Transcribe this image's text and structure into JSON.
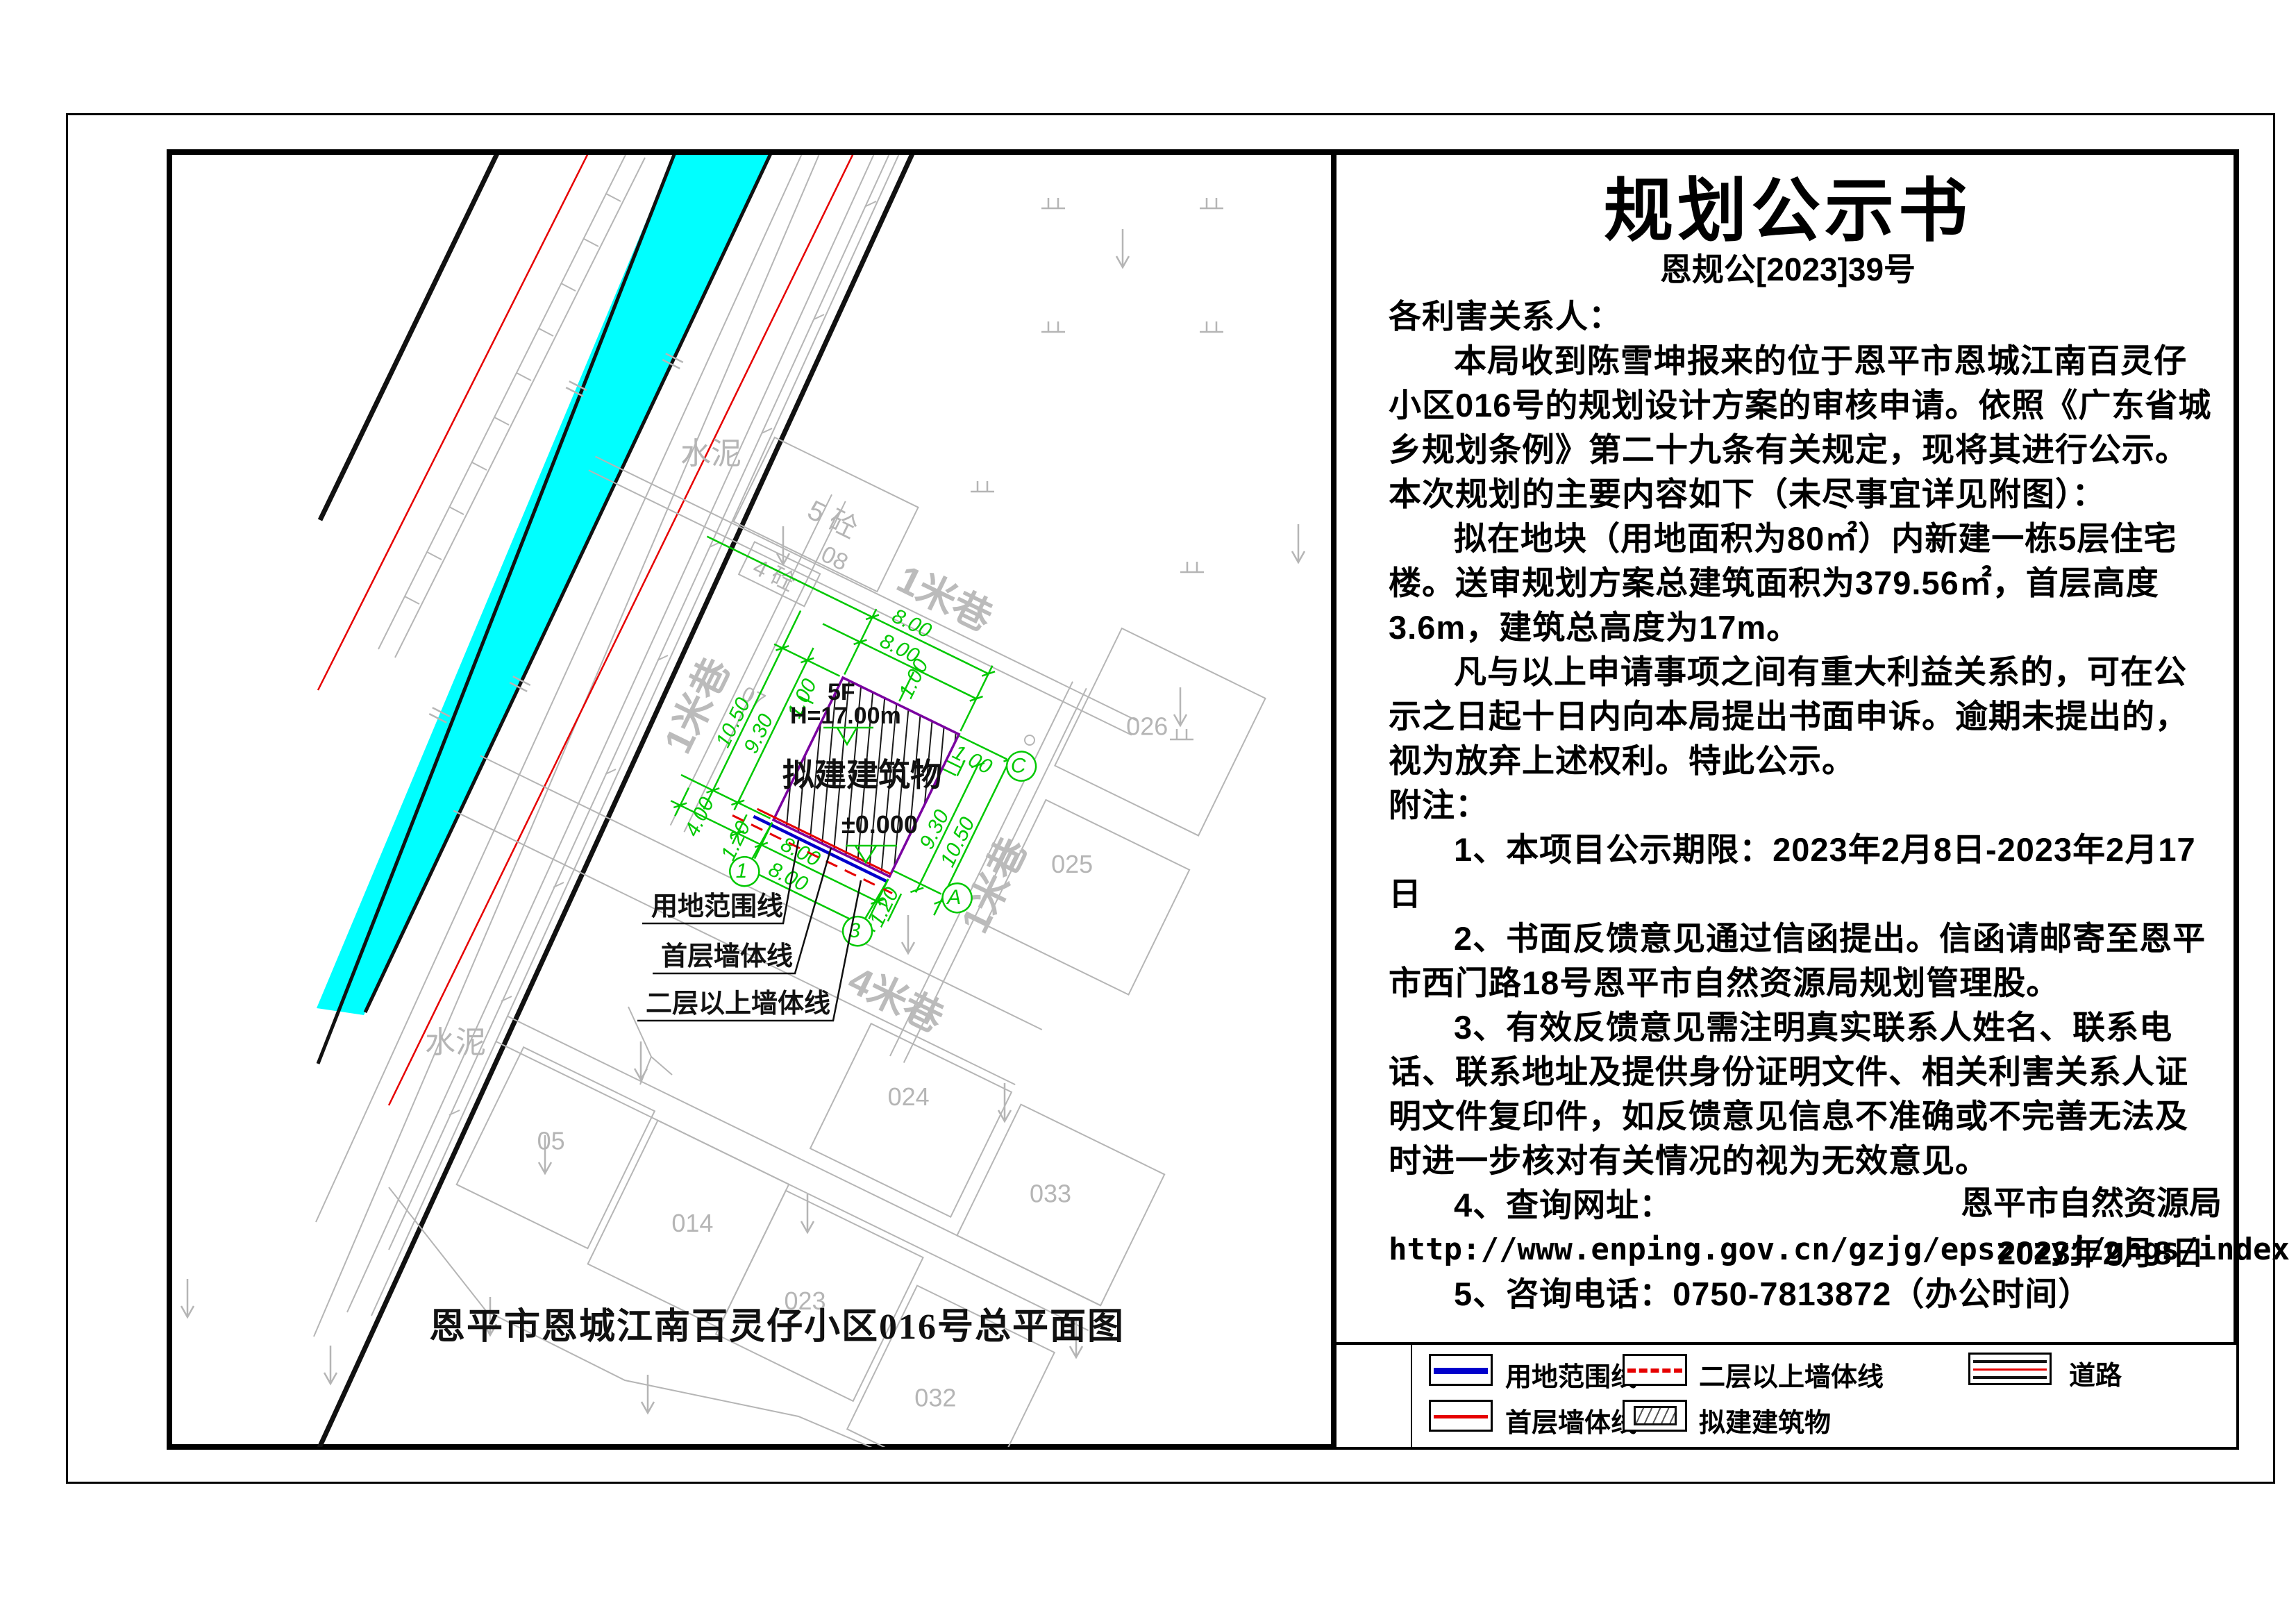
{
  "notice": {
    "title": "规划公示书",
    "doc_no": "恩规公[2023]39号",
    "salutation": "各利害关系人：",
    "para1": "本局收到陈雪坤报来的位于恩平市恩城江南百灵仔小区016号的规划设计方案的审核申请。依照《广东省城乡规划条例》第二十九条有关规定，现将其进行公示。本次规划的主要内容如下（未尽事宜详见附图）：",
    "para2": "拟在地块（用地面积为80㎡）内新建一栋5层住宅楼。送审规划方案总建筑面积为379.56㎡，首层高度3.6m，建筑总高度为17m。",
    "para3": "凡与以上申请事项之间有重大利益关系的，可在公示之日起十日内向本局提出书面申诉。逾期未提出的，视为放弃上述权利。特此公示。",
    "notes_label": "附注：",
    "note1": "1、本项目公示期限：2023年2月8日-2023年2月17日",
    "note2": "2、书面反馈意见通过信函提出。信函请邮寄至恩平市西门路18号恩平市自然资源局规划管理股。",
    "note3": "3、有效反馈意见需注明真实联系人姓名、联系电话、联系地址及提供身份证明文件、相关利害关系人证明文件复印件，如反馈意见信息不准确或不完善无法及时进一步核对有关情况的视为无效意见。",
    "note4": "4、查询网址：",
    "url": "http://www.enping.gov.cn/gzjg/epszrzyj/ghgs/index.html。",
    "note5": "5、咨询电话：0750-7813872（办公时间）",
    "agency": "恩平市自然资源局",
    "date": "2023年2月8日"
  },
  "legend": {
    "items": [
      {
        "label": "用地范围线",
        "symbol": "blue-line",
        "color": "#0000cc"
      },
      {
        "label": "首层墙体线",
        "symbol": "red-line",
        "color": "#e60000"
      },
      {
        "label": "二层以上墙体线",
        "symbol": "red-dashed-line",
        "color": "#e60000"
      },
      {
        "label": "拟建建筑物",
        "symbol": "hatched-box",
        "color": "#111111"
      },
      {
        "label": "道路",
        "symbol": "road-lines",
        "color": "#111111"
      }
    ]
  },
  "map": {
    "caption": "恩平市恩城江南百灵仔小区016号总平面图",
    "plot": {
      "floors": "5F",
      "height": "H=17.00m",
      "label": "拟建建筑物",
      "level": "±0.000"
    },
    "dims": {
      "top_outer": "8.00",
      "top_inner": "8.00",
      "top_offset": "1.00",
      "left_outer": "10.50",
      "left_inner": "9.30",
      "left_offset": "1.00",
      "right_offset": "1.00",
      "right_inner": "9.30",
      "right_outer": "10.50",
      "bottom_inner": "8.00",
      "bottom_outer": "8.00",
      "side_left": "4.00",
      "side_left2": "1.20",
      "side_right": "1.20"
    },
    "axes": {
      "a1": "1",
      "a3": "3",
      "ac": "C",
      "aa": "A"
    },
    "streets": {
      "top": "1米巷",
      "left": "1米巷",
      "right": "1米巷",
      "bottom": "4米巷"
    },
    "parcels": {
      "c5": "5 砼",
      "c5no": "08",
      "c4": "4 砼",
      "p07": "07",
      "p026": "026",
      "p025": "025",
      "p024": "024",
      "p033": "033",
      "p023": "023",
      "p032": "032",
      "p014": "014",
      "p05": "05"
    },
    "ground": {
      "cement1": "水泥",
      "cement2": "水泥"
    },
    "annotations": {
      "boundary": "用地范围线",
      "first_floor": "首层墙体线",
      "upper_floor": "二层以上墙体线"
    },
    "colors": {
      "water": "#00ffff",
      "dims": "#00c800",
      "plot_boundary": "#7a00a0",
      "boundary_line": "#0000cc",
      "wall_line": "#e60000",
      "map_gray": "#b5b5b5"
    }
  }
}
